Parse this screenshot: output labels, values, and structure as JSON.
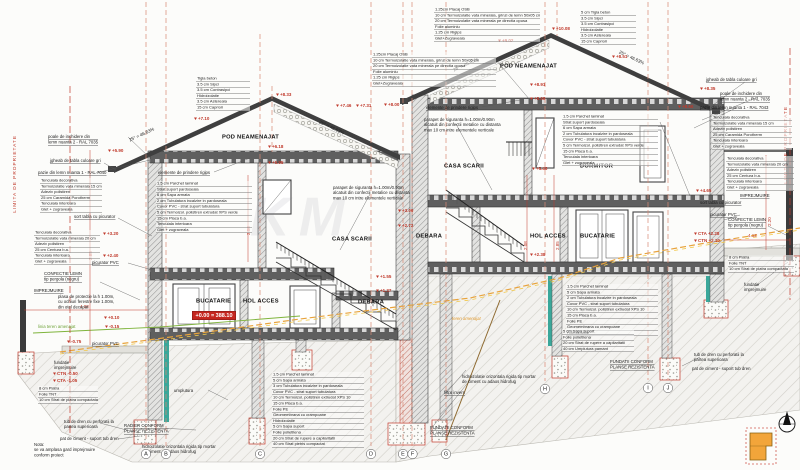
{
  "drawing": {
    "watermark": "KM",
    "property_limit": "LIMITA DE PROPRIETATE",
    "slope_label": "25° = 46.63%",
    "level_box": "+0.00 = 388.10"
  },
  "rooms": {
    "pod": "POD NEAMENAJAT",
    "casa_scarii": "CASA SCARII",
    "dormitor": "DORMITOR",
    "debara": "DEBARA",
    "hol_acces": "HOL ACCES",
    "bucatarie": "BUCATARIE"
  },
  "axes": [
    "A",
    "B",
    "C",
    "D",
    "E",
    "F",
    "G",
    "H",
    "I",
    "J"
  ],
  "elevations": {
    "e1008": "+10.08",
    "e902": "+9.02",
    "e891": "+8.91",
    "e868": "+8.68",
    "e851": "+8.51",
    "e860": "+8.60",
    "e835": "+8.35",
    "e833": "+8.33",
    "e800": "+8.00",
    "e746": "+7.46",
    "e731": "+7.31",
    "e710": "+7.10",
    "e618": "+6.18",
    "e595": "+5.95",
    "e590": "+5.90",
    "e548": "+5.48",
    "e465": "+4.65",
    "e320": "+3.20",
    "e300": "+3.00",
    "e272": "+2.72",
    "e240": "+2.40",
    "e238": "+2.38",
    "e155": "+1.55",
    "e137": "+1.37",
    "e010": "+0.10",
    "em015": "-0.15",
    "em075": "-0.75",
    "ctn_l": "CTN -0.50",
    "cta_l": "CTA -1.05",
    "cta_r": "CTA +2.28",
    "ctn_r": "CTN +2.10"
  },
  "dims": {
    "w408": "4.08",
    "w412": "4.12",
    "h285": "2.85",
    "h208": "2.08",
    "h220": "2.20"
  },
  "layers": {
    "roof_left": [
      "Tigla beton",
      "3.5 cm  Sipci",
      "3.5 cm  Contrasipci",
      "Hidroizolatie",
      "3.5 cm  Astereala",
      "15 cm  Capriori"
    ],
    "roof_right": [
      "5 cm  Tigla beton",
      "3.5 cm  Sipci",
      "3.5 cm  Contrasipci",
      "Hidroizolatie",
      "3.5 cm  Astereala",
      "15 cm  Capriori"
    ],
    "attic_ceiling": [
      "1.25cm Placaj OSB",
      "10 cm  Termoizolatie vata minerala, grinzi de lemn 50x05 cm",
      "20 cm  Termoizolatie vata minerala pe directia opusa",
      "Folie aluminiu",
      "1.25 cm Rigips",
      "Glet+Zugraveala"
    ],
    "floor_upper": [
      "1.5 cm  Parchet laminat",
      "Strat suport pardoseala",
      "6 cm  Sapa armata",
      "2 cm  Tubulatura incalzire in pardoseala",
      "Covor PVC - strat suport tubulatura",
      "5 cm  Termoizol. polistiren extrudat XPS verde",
      "15 cm  Placa b.a.",
      "Tencuiala interioara",
      "Glet + zugraveala"
    ],
    "slab_ground": [
      "1.5 cm  Parchet laminat",
      "5 cm  Sapa armata",
      "3 cm  Tubulatura incalzire in pardoseala",
      "Covor PVC - strat suport tubulatura",
      "10 cm  Termoizol. polistiren extrudat XPS 10",
      "15 cm  Placa b.a.",
      "Folie PE",
      "Geomembrana cu crampoane",
      "Hidroizolatie",
      "5 cm  Sapa suport",
      "Folie polietilena",
      "20 cm  Strat de rupere a capilaritatii",
      "40 cm  Strat pietris compactat"
    ],
    "slab_right_top": [
      "1.5 cm  Parchet laminat",
      "5 cm  Sapa armata",
      "2 cm  Tubulatura incalzire in pardoseala",
      "Covor PVC - strat suport tubulatura",
      "10 cm  Termoizol. polistiren extrudat XPS 10",
      "15 cm  Placa b.a.",
      "Folie PE",
      "Geomembrana cu crampoane",
      "Hidroizolatie"
    ],
    "slab_right_bottom": [
      "5 cm  Sapa suport",
      "Folie polietilena",
      "20 cm  Strat de rupere a capilaritatii",
      "40 cm  Umplutura pamant"
    ],
    "wall_brick": [
      "Tencuiala decorativa",
      "Termoizolatie vata minerala 15 cm",
      "Adeziv polistiren",
      "25 cm  Caramida Porotherm",
      "Tencuiala interioara",
      "Glet + zugraveala"
    ],
    "wall_centura": [
      "Tencuiala decorativa",
      "Termoizolatie vata minerala 20 cm",
      "Adeziv polistiren",
      "25 cm  Centura b.a.",
      "Tencuiala interioara",
      "Glet + zugraveala"
    ],
    "pavement": [
      "8 cm  Piatra",
      "Folie TNT",
      "10 cm  Strat de piatra compactata"
    ]
  },
  "notes": {
    "jgheab": "jgheab de tabla culoare gri",
    "pazie_1": "pazie din lemn nuanta 1 - RAL 7040",
    "pazie_2": "pazie din lemn nuanta 1 - RAL 7043",
    "poale": [
      "poale de inchidere din",
      "lemn nuanta 2 - RAL 7035"
    ],
    "parapet": [
      "parapet de siguranta h=1.00m/0.90m",
      "alcatuit din confectii metalice cu distanta",
      "max 10 cm intre elementele verticale"
    ],
    "rigips": "elemente de prindere rigips",
    "sort_tabla": "sort tabla cu picurator",
    "picurator": "picurator PVC",
    "pergola": [
      "CONFECTIE LEMN",
      "tip pergola (negru)"
    ],
    "imprejmuire": "IMPREJMUIRE",
    "plasa": [
      "plasa de protectie la h 1.00m,",
      "cu ochiuri ferestre fixe 1.00m,",
      "din otel decapat"
    ],
    "linia_teren": "linia teren amenajat",
    "teren_amenajat": "teren amenajat",
    "umplutura": "umplutura",
    "fundatie_imp": [
      "fundatie",
      "imprejmuire"
    ],
    "tub_dren": [
      "tub de dren cu perforatii la",
      "partea superioara"
    ],
    "pat_ciment": "pat de ciment - suport tub dren",
    "hidro_oriz": [
      "hidroizolatie orizontala rigida tip mortar",
      "de ciment cu adaos hidrofug"
    ],
    "radier": [
      "RADIER CONFORM",
      "PLANSE REZISTENTA"
    ],
    "fundatii": [
      "FUNDATII CONFORM",
      "PLANSE REZISTENTA"
    ],
    "filtru": "filtru invers",
    "nota": [
      "Nota:",
      "se va amplasa gard imprejmuire",
      "conform proiect"
    ]
  }
}
